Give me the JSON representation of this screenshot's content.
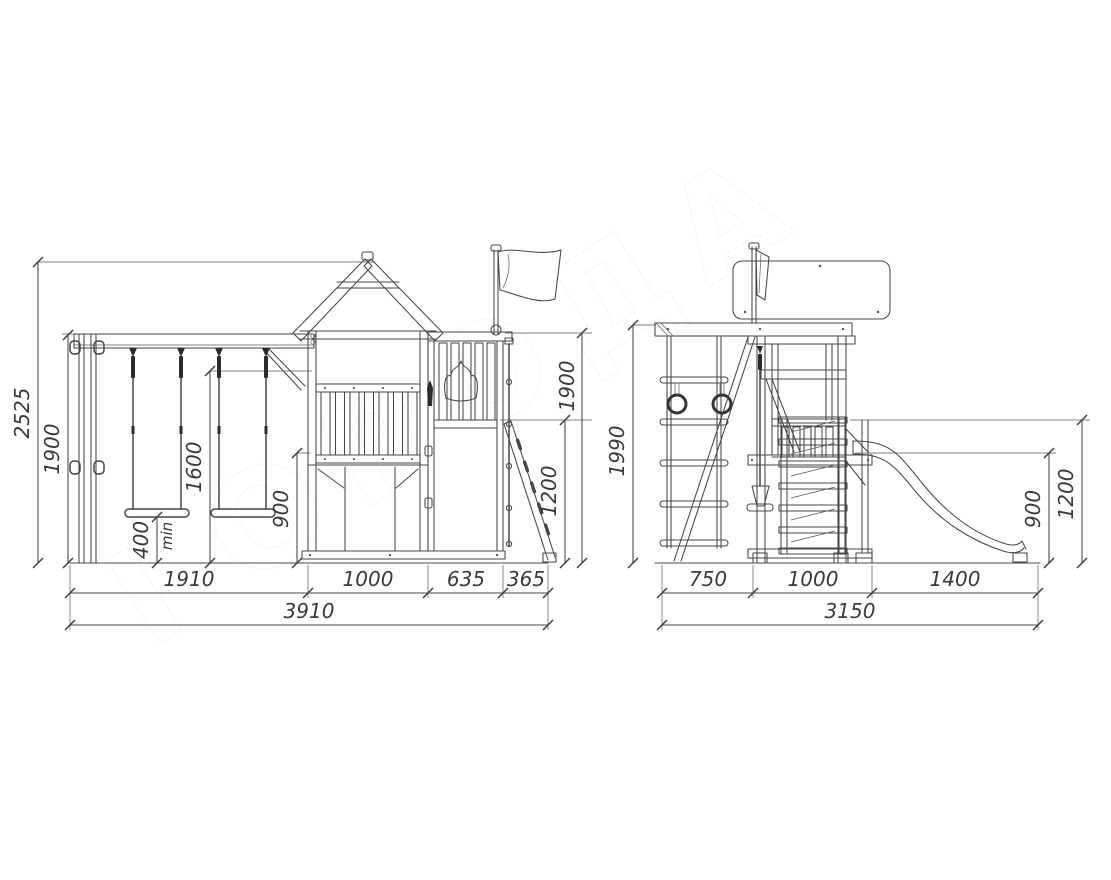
{
  "watermark": "ГОРОДА",
  "views": {
    "front": {
      "label": "front elevation",
      "dims": {
        "overall_height": "2525",
        "beam_height": "1900",
        "seat_height": "400",
        "seat_height_note": "min",
        "swing_clearance": "1600",
        "deck_height": "900",
        "tower_right_height": "1900",
        "ramp_top_height": "1200",
        "segments": [
          "1910",
          "1000",
          "635",
          "365"
        ],
        "total_width": "3910"
      }
    },
    "side": {
      "label": "side elevation",
      "dims": {
        "overall_height": "1990",
        "slide_start_height": "900",
        "platform_height": "1200",
        "segments": [
          "750",
          "1000",
          "1400"
        ],
        "total_width": "3150"
      }
    }
  }
}
